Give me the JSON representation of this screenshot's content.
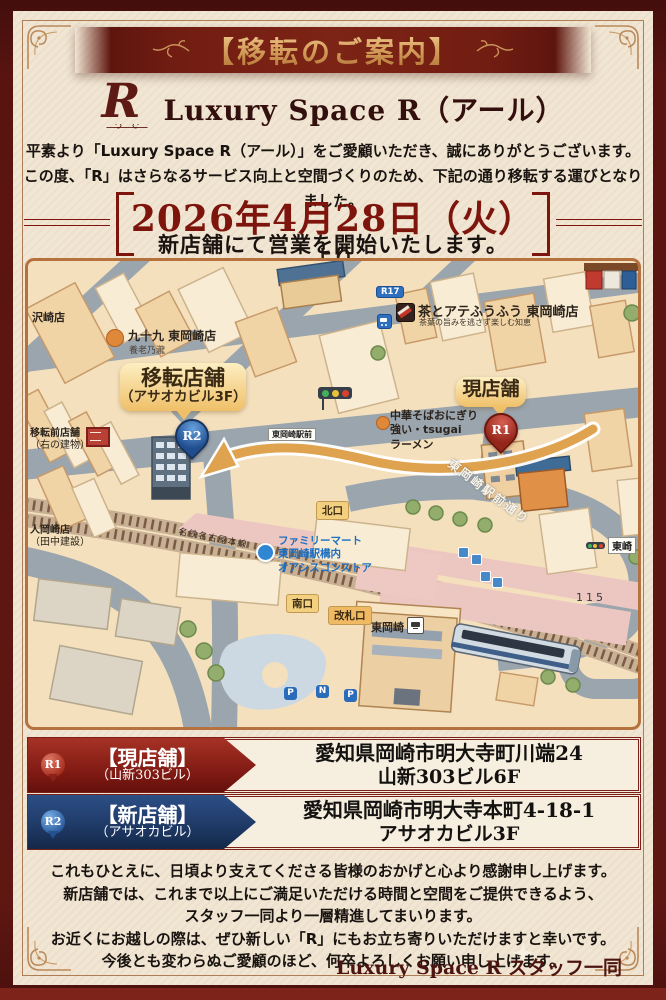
{
  "colors": {
    "frame_maroon": "#5a1410",
    "page_cream": "#f1e6d3",
    "ribbon_maroon": "#7c2415",
    "gold": "#d8a361",
    "current_store_red": "#7c1812",
    "new_store_blue": "#1c355f"
  },
  "header": {
    "banner_title": "【移転のご案内】"
  },
  "brand": {
    "logo": "R",
    "name": "Luxury Space R（アール）"
  },
  "intro": {
    "lines": [
      "平素より「Luxury Space R（アール）」をご愛顧いただき、誠にありがとうございます。",
      "この度、「R」はさらなるサービス向上と空間づくりのため、下記の通り移転する運びとなりました。"
    ]
  },
  "date_notice": {
    "date": "2026年4月28日（火）",
    "suffix": "より",
    "line2": "新店舗にて営業を開始いたします。"
  },
  "map": {
    "labels": {
      "sawazaki": "沢崎店",
      "tsukumo": "九十九 東岡崎店",
      "yoro": "養老乃瀧",
      "tea_shop": "茶とアテふうふう 東岡崎店",
      "tea_shop_sub": "茶葉の旨みを逃さず楽しむ知恵",
      "route_r17": "R17",
      "new_balloon_line1": "移転店舗",
      "new_balloon_line2": "（アサオカビル3F）",
      "pin_new": "R2",
      "old_note_line1": "移転前店舗",
      "old_note_line2": "（右の建物）",
      "current_balloon": "現店舗",
      "pin_current": "R1",
      "ramen_line1": "中華そばおにぎり",
      "ramen_line2": "強い・tsugai",
      "ramen_line3": "ラーメン",
      "bus_stop": "東岡崎駅前",
      "north_gate": "北口",
      "south_gate": "南口",
      "ticket_gate": "改札口",
      "fm_line1": "ファミリーマート",
      "fm_line2": "東岡崎駅構内",
      "fm_line3": "オアシスコンストア",
      "rail_line": "名鉄名古屋本線",
      "station": "東岡崎",
      "road_name": "東岡崎駅前通り",
      "route_115": "115",
      "sign_right": "東崎",
      "left_shop_line1": "人岡崎店",
      "left_shop_line2": "（田中建設）",
      "parking1": "P",
      "parking2": "N",
      "parking3": "P"
    }
  },
  "stores": [
    {
      "pin": "R1",
      "title": "【現店舗】",
      "sub": "（山新303ビル）",
      "addr1": "愛知県岡崎市明大寺町川端24",
      "addr2": "山新303ビル6F"
    },
    {
      "pin": "R2",
      "title": "【新店舗】",
      "sub": "（アサオカビル）",
      "addr1": "愛知県岡崎市明大寺本町4-18-1",
      "addr2": "アサオカビル3F"
    }
  ],
  "closing": {
    "lines": [
      "これもひとえに、日頃より支えてくださる皆様のおかげと心より感謝申し上げます。",
      "新店舗では、これまで以上にご満足いただける時間と空間をご提供できるよう、",
      "スタッフ一同より一層精進してまいります。",
      "お近くにお越しの際は、ぜひ新しい「R」にもお立ち寄りいただけますと幸いです。",
      "今後とも変わらぬご愛顧のほど、何卒よろしくお願い申し上げます。"
    ]
  },
  "signature": "Luxury Space R スタッフ一同"
}
